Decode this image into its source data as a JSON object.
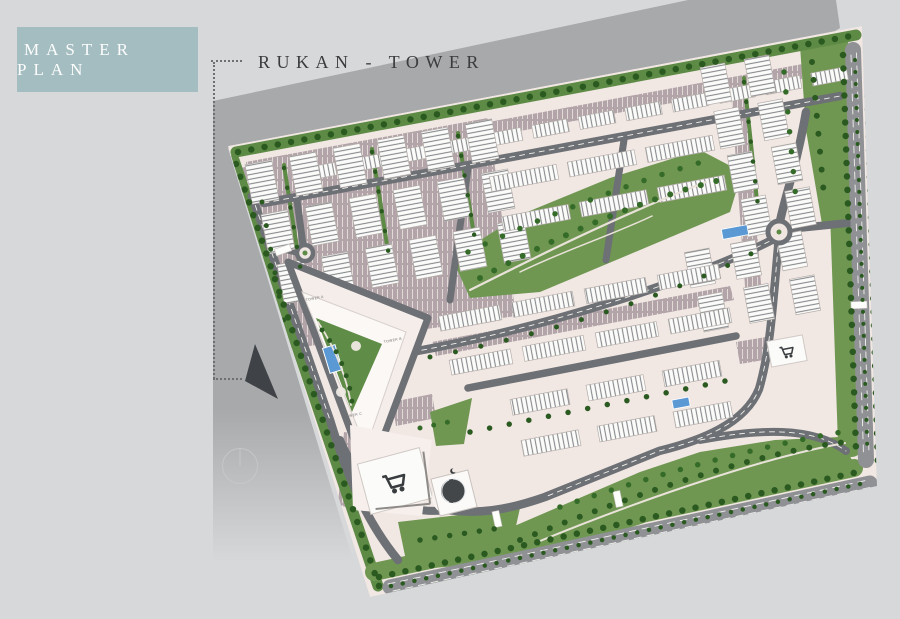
{
  "title_block": {
    "master_plan_label": "MASTER PLAN",
    "project_label": "RUKAN - TOWER"
  },
  "map": {
    "tower_labels": {
      "a": "TOWER A",
      "b": "TOWER B",
      "c": "TOWER C"
    }
  },
  "icons": {
    "north_arrow": "▲",
    "compass": "○",
    "mosque_crescent": "☾",
    "retail_cart": "cart"
  },
  "palette": {
    "background": "#d7d8da",
    "shadow": "#a8a9ab",
    "plan_base": "#f1e7e3",
    "plan_light": "#f6efec",
    "box": "#a4bdc0",
    "box_text": "#fdfdfd",
    "label_text": "#3b3b3d",
    "green": "#6f9752",
    "green_band": "#5d8a45",
    "tree": "#2b5a21",
    "tree_alt": "#356b28",
    "road": "#6d7074",
    "road_major": "#8f9194",
    "parking": "#b2a4a8",
    "pool": "#5b99d4",
    "building": "#fbfbfa",
    "charcoal": "#3f4347",
    "path_light": "#e9e2d9"
  }
}
